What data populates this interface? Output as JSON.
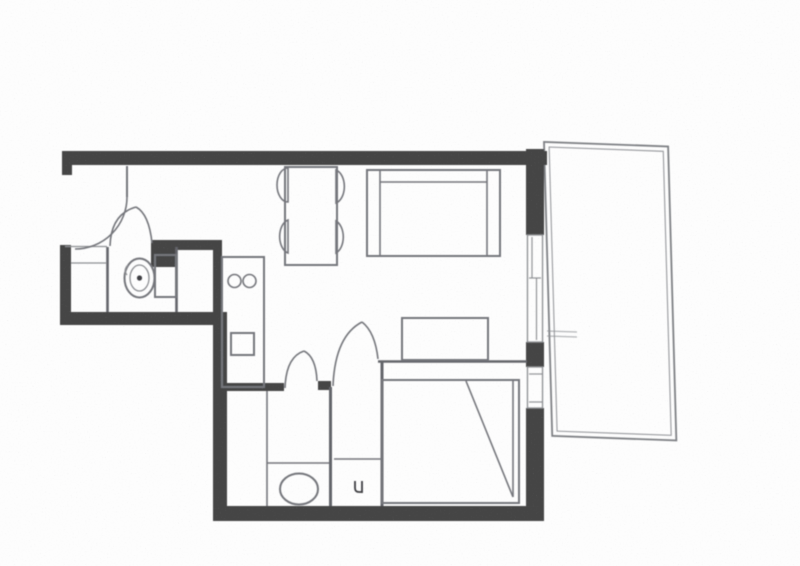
{
  "colors": {
    "bg": "#fdfdfd",
    "wall": "#454545",
    "partition": "#63656a",
    "furniture": "#74767b",
    "light": "#8d8f93",
    "dark": "#3e3e42"
  },
  "plan": {
    "symbols": [
      {
        "name": "entrance-door-swing"
      },
      {
        "name": "wc-door-swing"
      },
      {
        "name": "toilet"
      },
      {
        "name": "closet-shelf"
      },
      {
        "name": "kitchen-counter"
      },
      {
        "name": "hob-burner",
        "count": 2
      },
      {
        "name": "kitchen-sink"
      },
      {
        "name": "dining-table"
      },
      {
        "name": "dining-chair",
        "count": 4
      },
      {
        "name": "sofa"
      },
      {
        "name": "cabinet"
      },
      {
        "name": "bathroom-door-swing"
      },
      {
        "name": "bedroom-door-swing"
      },
      {
        "name": "double-bed"
      },
      {
        "name": "washbasin"
      },
      {
        "name": "drain-symbol"
      },
      {
        "name": "balcony-door-window"
      },
      {
        "name": "bedroom-window"
      },
      {
        "name": "balcony-terrace"
      }
    ]
  }
}
